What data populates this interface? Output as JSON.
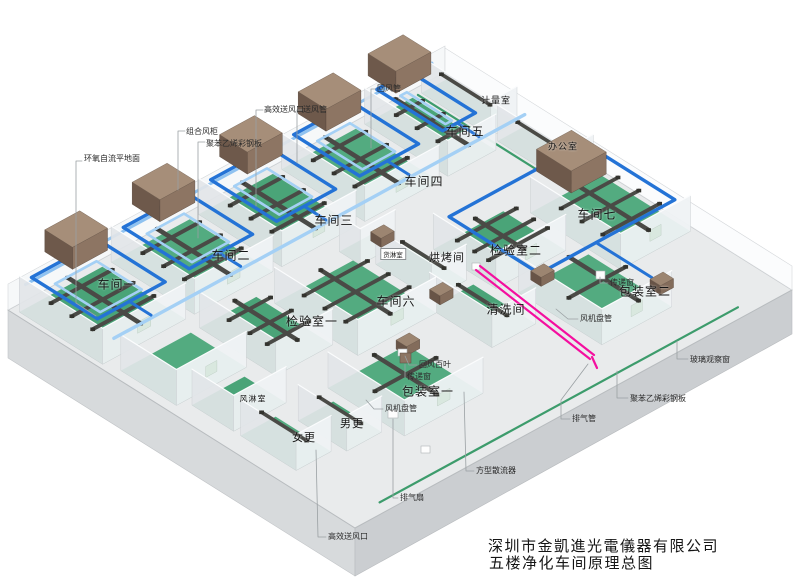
{
  "title_block": {
    "company": "深圳市金凱進光電儀器有限公司",
    "drawing_title": "五楼净化车间原理总图"
  },
  "rooms": {
    "ws1": "车间一",
    "ws2": "车间二",
    "ws3": "车间三",
    "ws4": "车间四",
    "ws5": "车间五",
    "ws6": "车间六",
    "ws7": "车间七",
    "metrology": "计量室",
    "office": "办公室",
    "inspection1": "检验室一",
    "inspection2": "检验室二",
    "baking": "烘烤间",
    "cargo_shower": "货淋室",
    "cleaning": "清洗间",
    "packing1": "包装室一",
    "packing2": "包装室二",
    "men_changing": "男更",
    "women_changing": "女更",
    "air_shower": "风淋室"
  },
  "callouts": {
    "epoxy_floor": "环氧自流平地面",
    "combined_ahu": "组合风柜",
    "steel_panel_a": "聚苯乙烯彩钢板",
    "hepa_outlet_a": "高效送风口",
    "supply_duct": "送风管",
    "return_duct": "回风管",
    "return_louver": "回风百叶",
    "pass_window_a": "传递窗",
    "pass_window_b": "传递窗",
    "fan_coil_a": "风机盘管",
    "fan_coil_b": "风机盘管",
    "exhaust_fan": "排气扇",
    "square_diffuser": "方型散流器",
    "hepa_outlet_b": "高效送风口",
    "exhaust_duct": "排气管",
    "glass_window": "玻璃观察窗",
    "steel_panel_b": "聚苯乙烯彩钢板"
  },
  "colors": {
    "floor_green": "#4ea87d",
    "duct_blue": "#2473d6",
    "duct_light_blue": "#a4d0f5",
    "duct_dark": "#4a4a46",
    "ahu_brown": "#a68e79",
    "exhaust_pink": "#f40f9f",
    "slab_gray": "#d6d9db"
  }
}
